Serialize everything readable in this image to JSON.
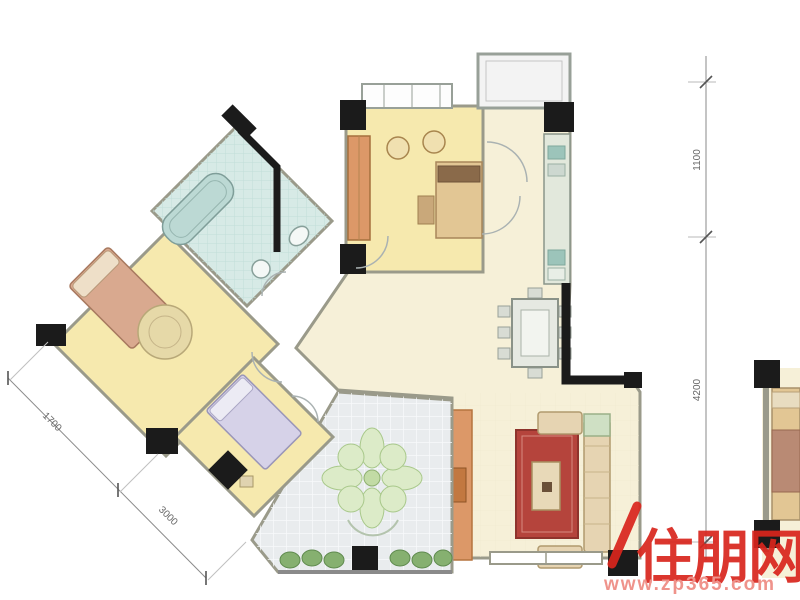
{
  "image": {
    "kind": "apartment-floor-plan",
    "description": "real-estate listing floor plan, partial adjacent unit at right edge"
  },
  "dimensions": {
    "right": {
      "orientation": "vertical",
      "labels": [
        "1100",
        "4200"
      ]
    },
    "bottom_left": {
      "orientation": "diagonal",
      "labels": [
        "1700",
        "3000"
      ]
    }
  },
  "watermark": {
    "brand": "住朋网",
    "website": "www.zp365.com",
    "brand_color": "#d9251d",
    "website_color": "#ee8a82"
  },
  "palette": {
    "living": "#f6f0d8",
    "bedroom": "#f6e9ae",
    "bathroom": "#d7eae6",
    "balcony": "#e9ecee",
    "utility": "#f3f3f3",
    "rug": "#b5443c",
    "wood": "#dc9868",
    "counter": "#e2e8dc",
    "sink": "#9cc4ba",
    "bed": "#e2c694",
    "bed_master": "#d9a98f",
    "bed_lavender": "#d6d2e8",
    "tub": "#bcd9d4",
    "plant": "#86b070",
    "plant_light": "#dcebc8",
    "sofa": "#e6d4b2",
    "wall": "#9a9a8a",
    "column": "#1b1b1b",
    "dimension": "#666666"
  }
}
